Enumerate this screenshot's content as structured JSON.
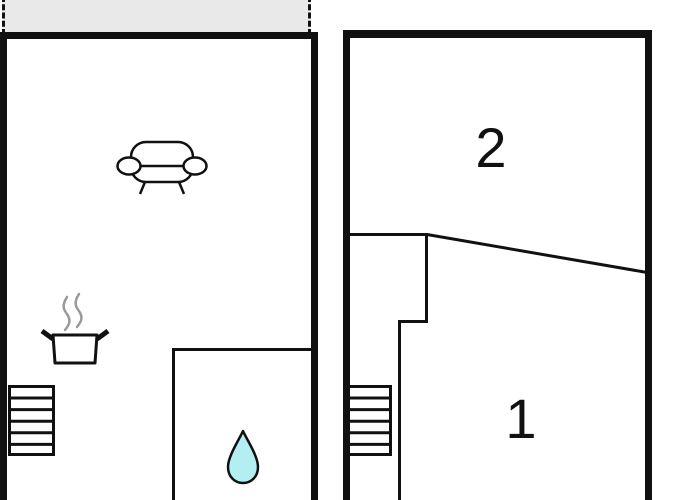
{
  "app": {
    "type": "floor-plan",
    "description": "Two-storey floor plan with two units"
  },
  "colors": {
    "wall": "#111111",
    "balcony_fill": "#e9e9e9",
    "water_drop_fill": "#b3eef2",
    "steam_gray": "#999999",
    "background": "#ffffff"
  },
  "floors": {
    "left_unit": {
      "name": "living-unit",
      "balcony": {
        "name": "balcony-terrace"
      },
      "icons": {
        "sofa": "sofa-icon",
        "cooking_pot": "cooking-pot-icon",
        "stairs": "stairs-icon",
        "water_drop": "water-drop-icon"
      }
    },
    "right_unit": {
      "name": "bedroom-unit",
      "rooms": [
        {
          "label": "2"
        },
        {
          "label": "1"
        }
      ],
      "icons": {
        "stairs": "stairs-icon"
      }
    }
  }
}
